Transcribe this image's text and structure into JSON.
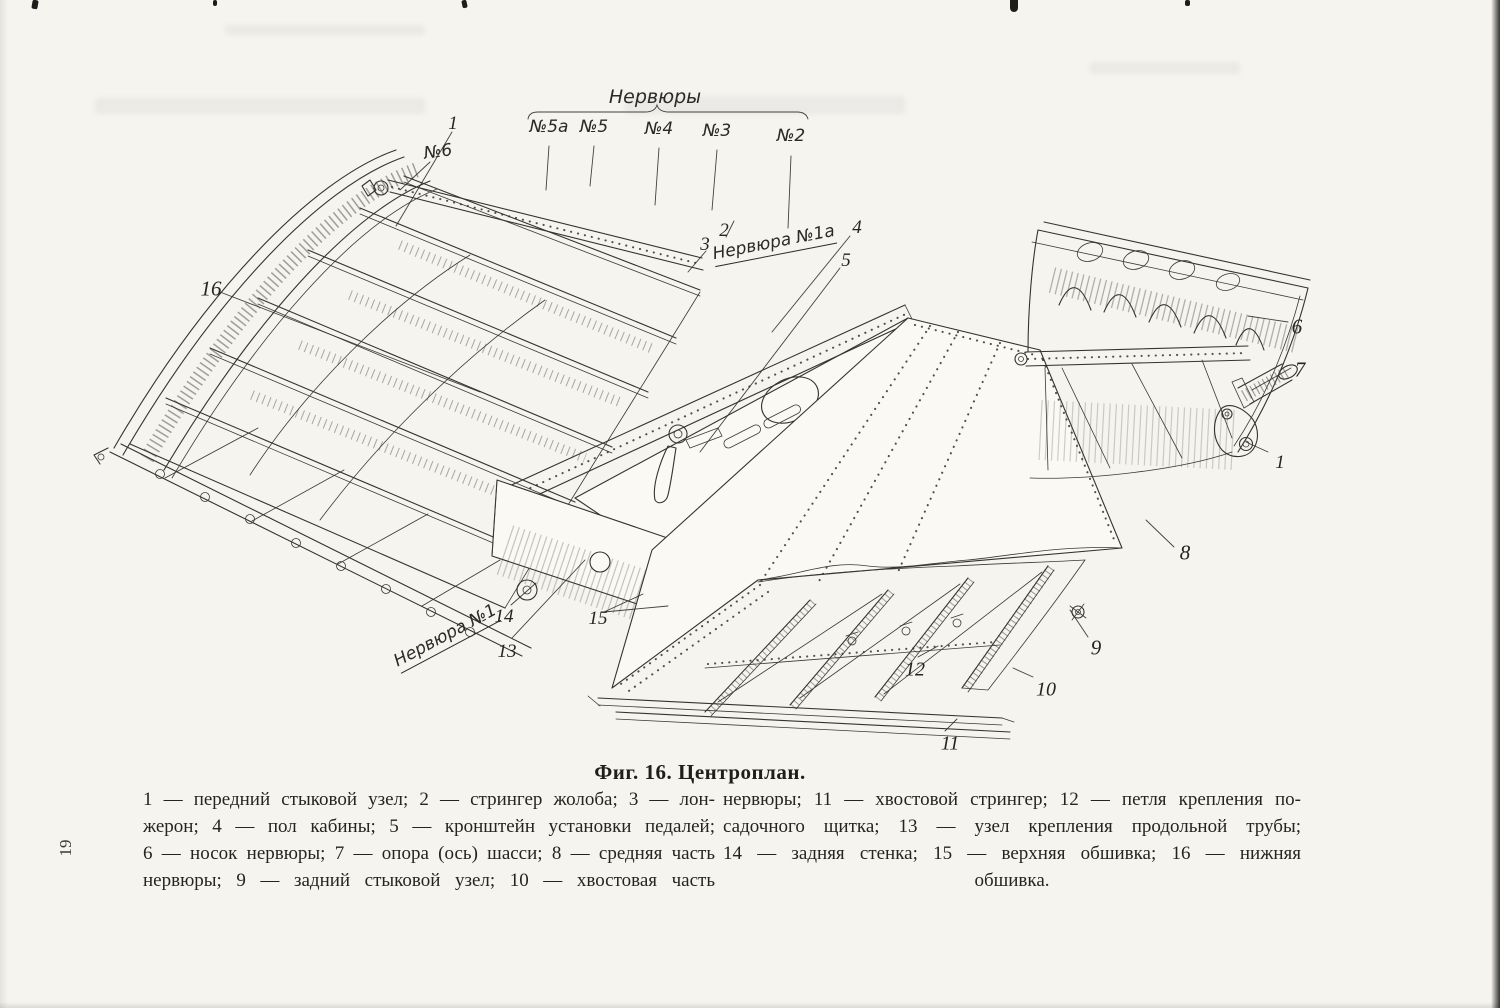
{
  "page": {
    "number": "19",
    "caption": "Фиг. 16. Центроплан."
  },
  "figure": {
    "labels": {
      "nervyury_header": "Нервюры",
      "rib_5a": "№5а",
      "rib_5": "№5",
      "rib_4": "№4",
      "rib_3": "№3",
      "rib_2": "№2",
      "rib_6": "№6",
      "nervyura_1a": "Нервюра №1а",
      "nervyura_1": "Нервюра №1"
    },
    "callouts": {
      "c1_left": "1",
      "c2_top": "2",
      "c3_top": "3",
      "c4": "4",
      "c5": "5",
      "c6": "6",
      "c7": "7",
      "c8": "8",
      "c9": "9",
      "c10": "10",
      "c11": "11",
      "c12": "12",
      "c13": "13",
      "c14": "14",
      "c15": "15",
      "c16": "16",
      "c1_right": "1"
    }
  },
  "legend": {
    "left_column": [
      "1 — передний стыковой узел; 2 — стрингер жолоба; 3 — лон-",
      "жерон; 4 — пол кабины; 5 — кронштейн установки педалей;",
      "6 — носок нервюры; 7 — опора (ось) шасси; 8 — средняя часть",
      "нервюры; 9 — задний стыковой узел; 10 — хвостовая часть"
    ],
    "right_column": [
      "нервюры; 11 — хвостовой стрингер; 12 — петля крепления по-",
      "садочного щитка; 13 — узел крепления продольной трубы;",
      "14 — задняя стенка; 15 — верхняя обшивка; 16 — нижняя",
      "обшивка."
    ]
  }
}
